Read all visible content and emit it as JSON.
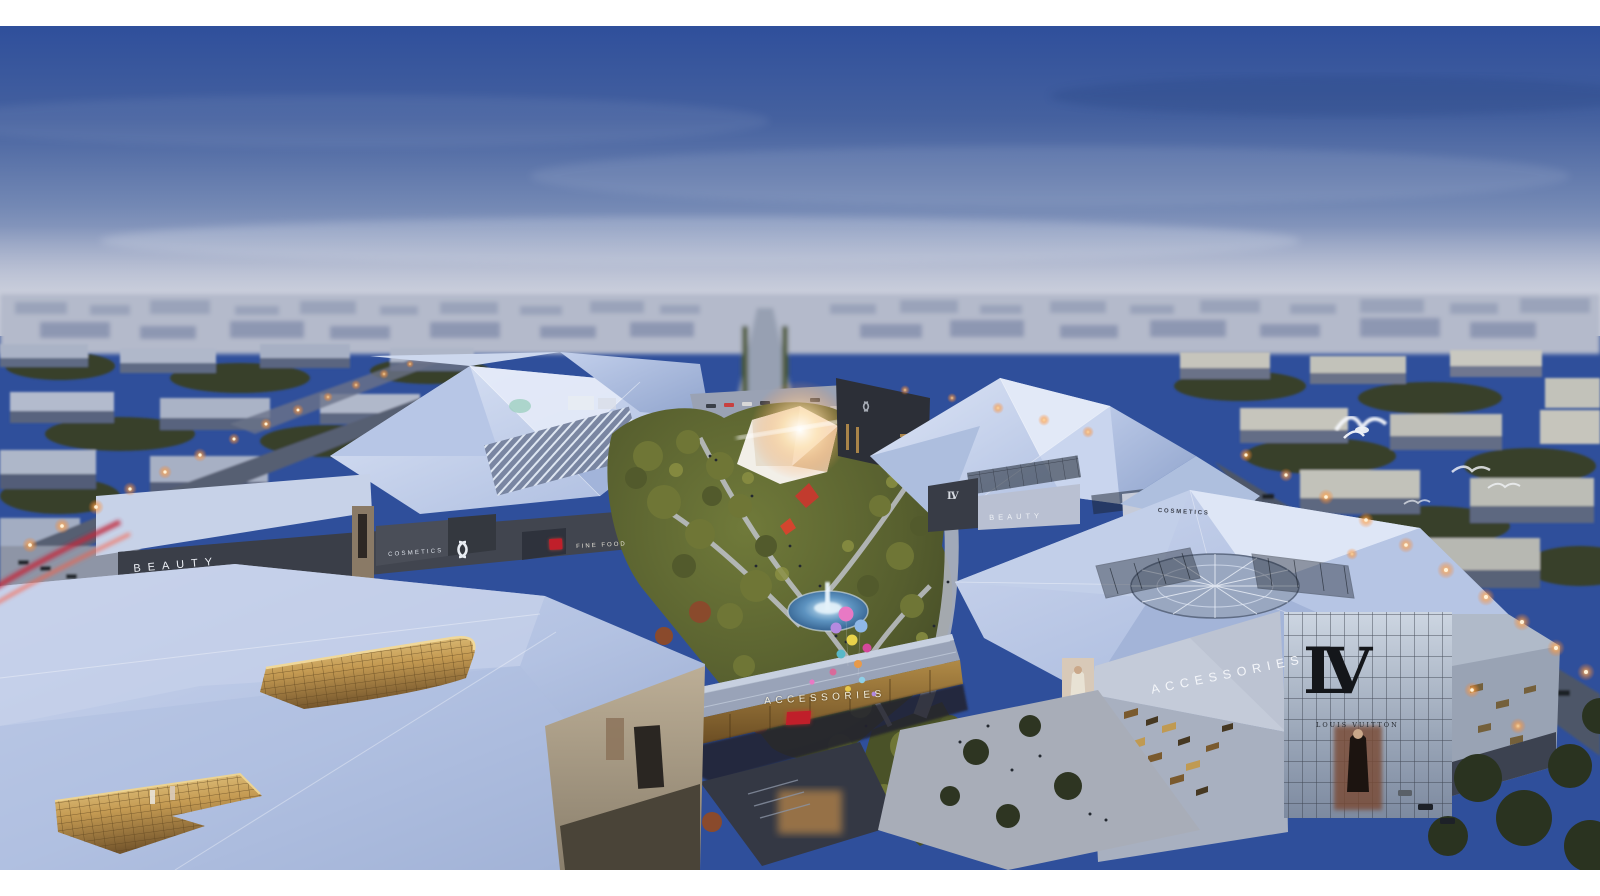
{
  "scene": {
    "title": "Aerial dusk architectural rendering of a luxury outlet mall with faceted white roofs, central landscaped plaza, pedestrian bridge and brand signage",
    "type": "architectural-rendering"
  },
  "palette": {
    "letterbox": "#ffffff",
    "sign-white": "#edf0f6",
    "sign-dark": "#3c414d",
    "lv-black": "#14161a",
    "red-sign": "#c01f2a",
    "sky-top": "#2f4f9b",
    "sky-horizon": "#c9cedb",
    "roof-light": "#d6dff4",
    "roof-shade": "#9db0d8",
    "gold-glass": "#c9a35a",
    "streetlight": "#ff9a3e",
    "water": "#3a6f9e"
  },
  "signs": {
    "beauty_left": "BEAUTY",
    "cosmetics_left": "COSMETICS",
    "fine_food": "FINE FOOD",
    "accessories_bridge": "ACCESSORIES",
    "beauty_mid": "BEAUTY",
    "lv_small": "LV",
    "cosmetics_right": "COSMETICS",
    "accessories_right": "ACCESSORIES",
    "lv_monogram": "LV",
    "louis_vuitton": "LOUIS VUITTON"
  },
  "icons": {
    "chanel_logo": "interlocked-cc",
    "birds": "seagulls-in-flight",
    "balloons": "party-balloon-cluster",
    "fountain": "lit-fountain-pool"
  }
}
